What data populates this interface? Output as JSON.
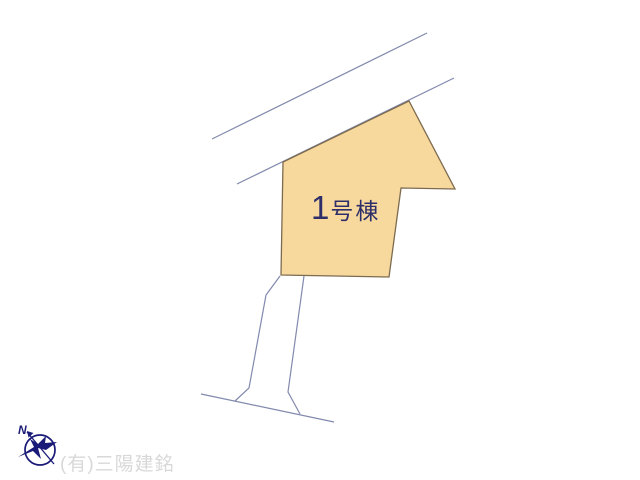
{
  "map": {
    "building": {
      "number": "1",
      "suffix": "号棟"
    },
    "compass": {
      "letter": "N"
    }
  },
  "watermark": {
    "company": "(有)三陽建銘"
  },
  "colors": {
    "background": "#ffffff",
    "plot_fill": "#f7d99d",
    "plot_stroke": "#7d6b50",
    "road_line": "#8289ad",
    "label_text": "#2e2e6a",
    "compass": "#1a1a78",
    "watermark_text": "#d8d8d8"
  }
}
